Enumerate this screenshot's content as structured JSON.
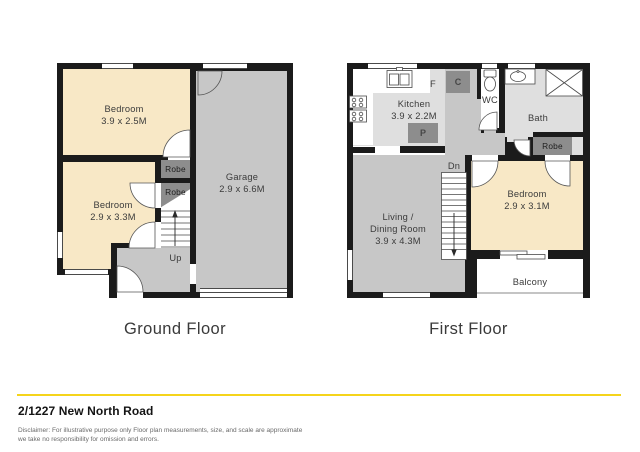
{
  "title": "2/1227 New North Road",
  "disclaimer": {
    "line1": "Disclaimer: For illustrative purpose only Floor plan measurements, size, and scale are approximate",
    "line2": "we take no responsibility for omission and errors."
  },
  "palette": {
    "accent_line": "#F5D41B",
    "wall": "#1b1b1b",
    "bedroom_fill": "#F8E8C6",
    "floor_gray": "#C7C7C7",
    "room_light_gray": "#DFDFDF",
    "closet_dark_gray": "#8D8D8D"
  },
  "ground_floor": {
    "caption": "Ground Floor",
    "bedroom1": {
      "name": "Bedroom",
      "dims": "3.9 x 2.5M"
    },
    "bedroom2": {
      "name": "Bedroom",
      "dims": "2.9 x 3.3M"
    },
    "garage": {
      "name": "Garage",
      "dims": "2.9 x 6.6M"
    },
    "robe1": "Robe",
    "robe2": "Robe",
    "stairs_label": "Up"
  },
  "first_floor": {
    "caption": "First Floor",
    "kitchen": {
      "name": "Kitchen",
      "dims": "3.9 x 2.2M"
    },
    "fridge_label": "F",
    "cupboard_label": "C",
    "pantry_label": "P",
    "wc_label": "WC",
    "bath_label": "Bath",
    "robe_label": "Robe",
    "bedroom": {
      "name": "Bedroom",
      "dims": "2.9 x 3.1M"
    },
    "living": {
      "line1": "Living /",
      "line2": "Dining Room",
      "dims": "3.9 x 4.3M"
    },
    "stairs_label": "Dn",
    "balcony_label": "Balcony"
  }
}
